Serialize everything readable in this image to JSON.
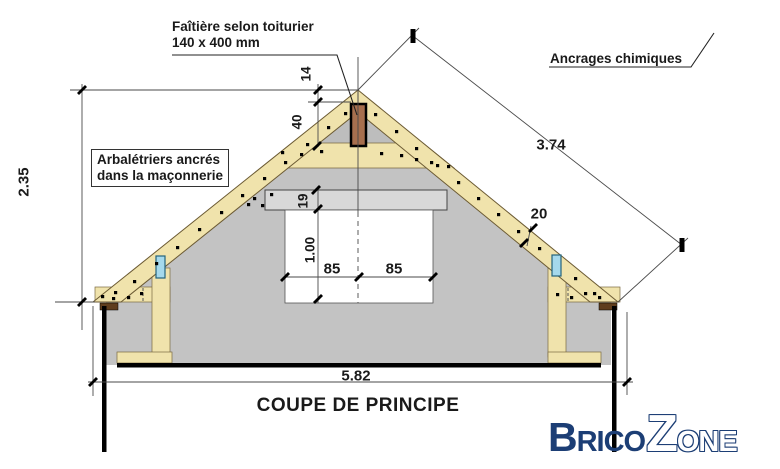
{
  "drawing": {
    "title": "COUPE DE PRINCIPE",
    "labels": {
      "ridge_line1": "Faîtière selon toiturier",
      "ridge_line2": "140 x 400 mm",
      "chemical_anchors": "Ancrages chimiques",
      "rafters_note_line1": "Arbalétriers ancrés",
      "rafters_note_line2": "dans la maçonnerie"
    },
    "dimensions": {
      "left_height": "2.35",
      "ridge_top_offset": "14",
      "ridge_beam_height": "40",
      "lintel_height": "19",
      "opening_height": "1.00",
      "opening_left_half": "85",
      "opening_right_half": "85",
      "rafter_depth": "20",
      "slope_length": "3.74",
      "total_width": "5.82"
    },
    "colors": {
      "wood": "#f0e3ac",
      "wall_gray": "#c3c3c3",
      "lintel_gray": "#d8d8d8",
      "ridge_brown": "#a76f4e",
      "plate_brown": "#5f3d1d",
      "anchor_blue": "#a5d9ec",
      "logo_navy": "#1c3e75"
    }
  },
  "logo": {
    "part1": "Brico",
    "part2": "Zone"
  }
}
